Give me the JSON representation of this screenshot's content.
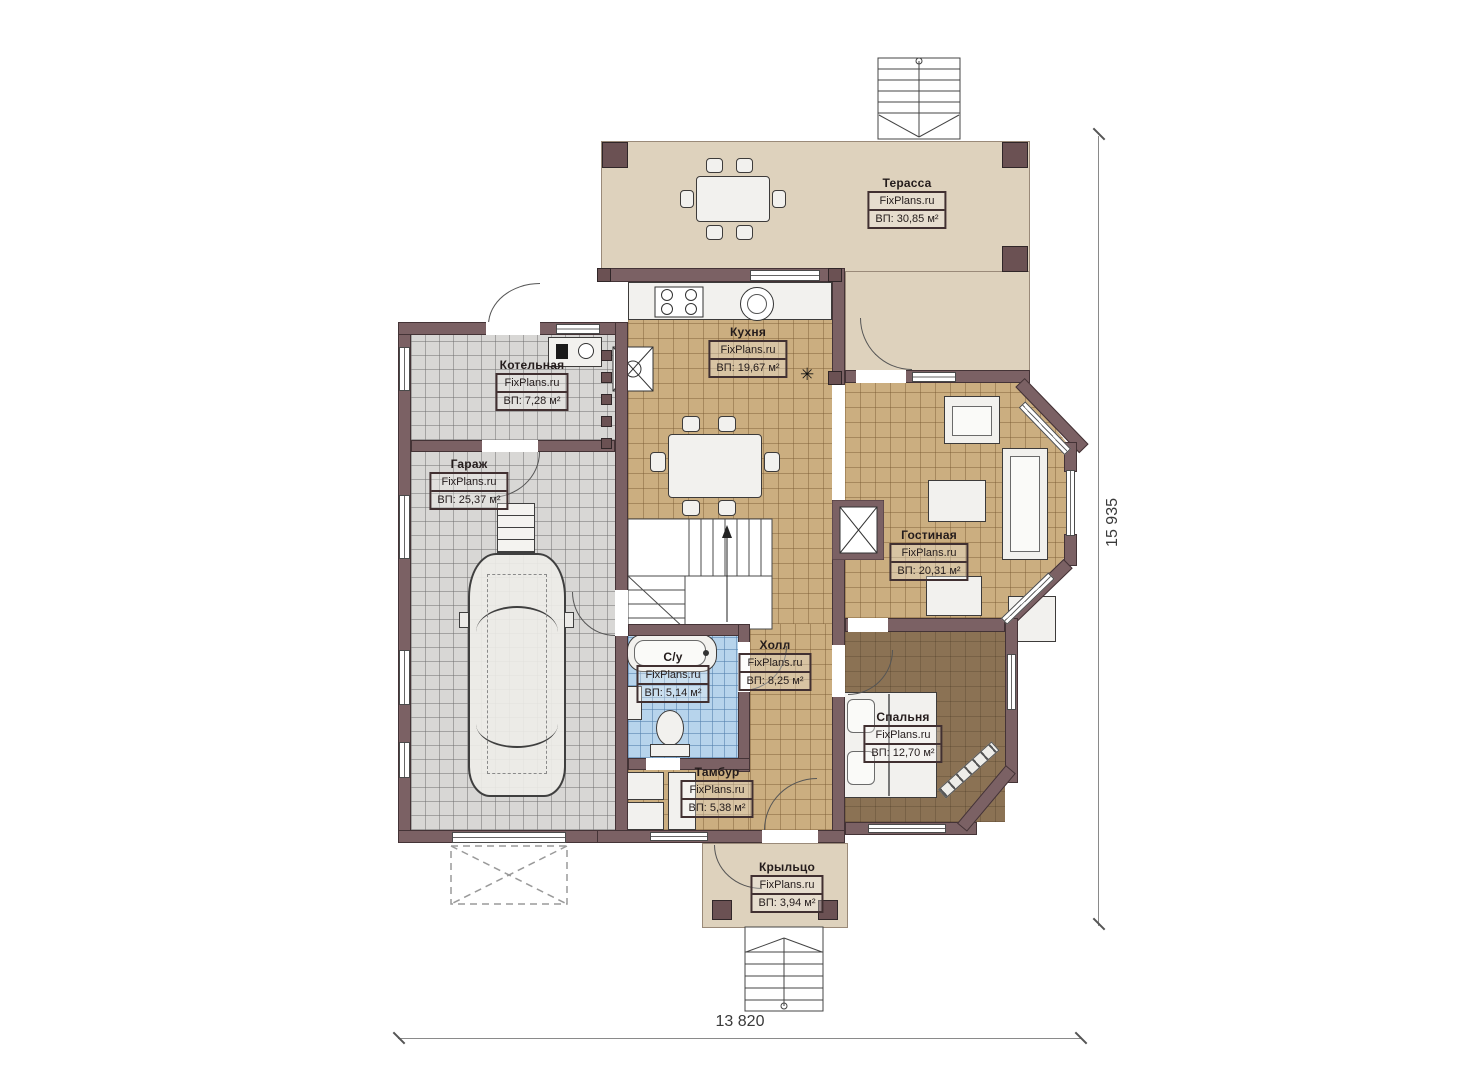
{
  "watermark": "FixPlans.ru",
  "icons": {
    "flue": "✳"
  },
  "rooms": {
    "terrace": {
      "name": "Терасса",
      "area": "ВП: 30,85 м²"
    },
    "kitchen": {
      "name": "Кухня",
      "area": "ВП: 19,67 м²"
    },
    "boiler": {
      "name": "Котельная",
      "area": "ВП: 7,28 м²"
    },
    "garage": {
      "name": "Гараж",
      "area": "ВП: 25,37 м²"
    },
    "living": {
      "name": "Гостиная",
      "area": "ВП: 20,31 м²"
    },
    "bathroom": {
      "name": "С/у",
      "area": "ВП: 5,14 м²"
    },
    "hall": {
      "name": "Холл",
      "area": "ВП: 8,25 м²"
    },
    "bedroom": {
      "name": "Спальня",
      "area": "ВП: 12,70 м²"
    },
    "vestibule": {
      "name": "Тамбур",
      "area": "ВП: 5,38 м²"
    },
    "porch": {
      "name": "Крыльцо",
      "area": "ВП: 3,94 м²"
    }
  },
  "dimensions": {
    "horizontal": "13 820",
    "vertical": "15 935"
  },
  "colors": {
    "wall": "#7b6164",
    "floor_tan": "#cbae80",
    "floor_gray": "#d8d7d5",
    "floor_blue": "#b7d4ec",
    "floor_bedroom": "#8b7254",
    "terrace": "#ded2bd"
  }
}
